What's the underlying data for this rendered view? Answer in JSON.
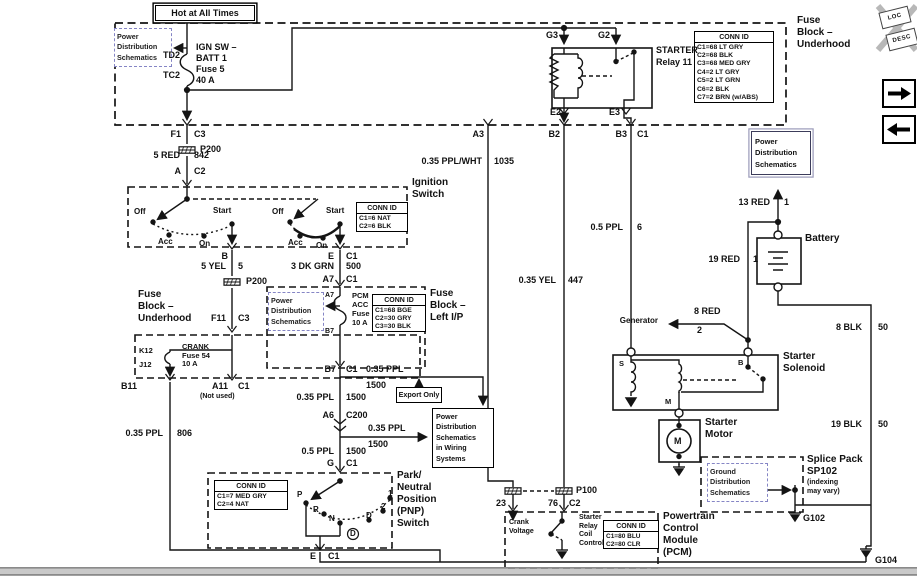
{
  "top": {
    "hot": "Hot at All Times",
    "pds": [
      "Power",
      "Distribution",
      "Schematics"
    ],
    "td2": "TD2",
    "tc2": "TC2",
    "fuse": [
      "IGN SW –",
      "BATT 1",
      "Fuse 5",
      "40 A"
    ],
    "fuse_block": [
      "Fuse",
      "Block –",
      "Underhood"
    ]
  },
  "conn_underhood": {
    "title": "CONN ID",
    "rows": [
      "C1=68 LT GRY",
      "C2=68 BLK",
      "C3=68 MED GRY",
      "C4=2 LT GRY",
      "C5=2 LT GRN",
      "C6=2 BLK",
      "C7=2 BRN (w/ABS)"
    ]
  },
  "relay": {
    "name": [
      "STARTER",
      "Relay 11"
    ],
    "g3": "G3",
    "g2": "G2",
    "e2": "E2",
    "e3": "E3",
    "a3": "A3",
    "b2": "B2",
    "b3": "B3",
    "c1": "C1"
  },
  "ign": {
    "f1": "F1",
    "c3": "C3",
    "p200": "P200",
    "w": "5 RED",
    "ckt": "842",
    "a": "A",
    "c2": "C2",
    "title": [
      "Ignition",
      "Switch"
    ],
    "conn": {
      "title": "CONN ID",
      "rows": [
        "C1=6 NAT",
        "C2=6 BLK"
      ]
    },
    "off": "Off",
    "acc": "Acc",
    "on": "On",
    "start": "Start",
    "b": "B",
    "e": "E",
    "c1": "C1"
  },
  "mid": {
    "w_yel": "5 YEL",
    "n5": "5",
    "p200": "P200",
    "w_grn": "3 DK GRN",
    "n500": "500",
    "a7": "A7",
    "c1": "C1",
    "f11": "F11",
    "c3": "C3"
  },
  "crank": {
    "block": [
      "Fuse",
      "Block –",
      "Underhood"
    ],
    "k12": "K12",
    "j12": "J12",
    "fuse": [
      "CRANK",
      "Fuse 54",
      "10 A"
    ],
    "b11": "B11",
    "a11": "A11",
    "c1": "C1",
    "not_used": "(Not used)",
    "w": "0.35 PPL",
    "ckt": "806"
  },
  "lip": {
    "pds": [
      "Power",
      "Distribution",
      "Schematics"
    ],
    "a7": "A7",
    "b7": "B7",
    "fuse": [
      "PCM",
      "ACC",
      "Fuse G",
      "10 A"
    ],
    "conn": {
      "title": "CONN ID",
      "rows": [
        "C1=68 BGE",
        "C2=30 GRY",
        "C3=30 BLK"
      ]
    },
    "title": [
      "Fuse",
      "Block –",
      "Left I/P"
    ]
  },
  "run": {
    "b7": "B7",
    "c1": "C1",
    "w": "0.35 PPL",
    "n1500": "1500",
    "export": "Export Only",
    "pdsw": [
      "Power",
      "Distribution",
      "Schematics",
      "in Wiring",
      "Systems"
    ],
    "a6": "A6",
    "c200": "C200",
    "w2": "0.5 PPL",
    "g": "G",
    "c1b": "C1"
  },
  "pnp": {
    "title": [
      "Park/",
      "Neutral",
      "Position",
      "(PNP)",
      "Switch"
    ],
    "conn": {
      "title": "CONN ID",
      "rows": [
        "C1=7 MED GRY",
        "C2=4 NAT"
      ]
    },
    "p": "P",
    "r": "R",
    "n": "N",
    "d": "D",
    "d2": "D",
    "two": "2",
    "one": "1",
    "e": "E",
    "c1": "C1"
  },
  "wires": {
    "pplwht": "0.35 PPL/WHT",
    "n1035": "1035",
    "yel": "0.35 YEL",
    "n447": "447",
    "ppl": "0.5 PPL",
    "n6": "6"
  },
  "pcm": {
    "p100": "P100",
    "n23": "23",
    "n76": "76",
    "c2": "C2",
    "crank": [
      "Crank",
      "Voltage"
    ],
    "src": [
      "Starter",
      "Relay",
      "Coil",
      "Control"
    ],
    "conn": {
      "title": "CONN ID",
      "rows": [
        "C1=80 BLU",
        "C2=80 CLR"
      ]
    },
    "title": [
      "Powertrain",
      "Control",
      "Module",
      "(PCM)"
    ]
  },
  "right": {
    "pds": [
      "Power",
      "Distribution",
      "Schematics"
    ],
    "w13": "13 RED",
    "n1": "1",
    "battery": "Battery",
    "w19": "19 RED",
    "n1b": "1",
    "gen": "Generator",
    "w8": "8 RED",
    "n2": "2",
    "sol": [
      "Starter",
      "Solenoid"
    ],
    "s": "S",
    "b": "B",
    "m": "M",
    "motor": [
      "Starter",
      "Motor"
    ],
    "mm": "M",
    "w8blk": "8 BLK",
    "n50": "50",
    "w19blk": "19 BLK",
    "n50b": "50",
    "gds": [
      "Ground",
      "Distribution",
      "Schematics"
    ],
    "splice": [
      "Splice Pack",
      "SP102",
      "(indexing",
      "may vary)"
    ],
    "g102": "G102",
    "g10": "G104"
  },
  "toolbar": {
    "loc": "LOC",
    "desc": "DESC"
  }
}
